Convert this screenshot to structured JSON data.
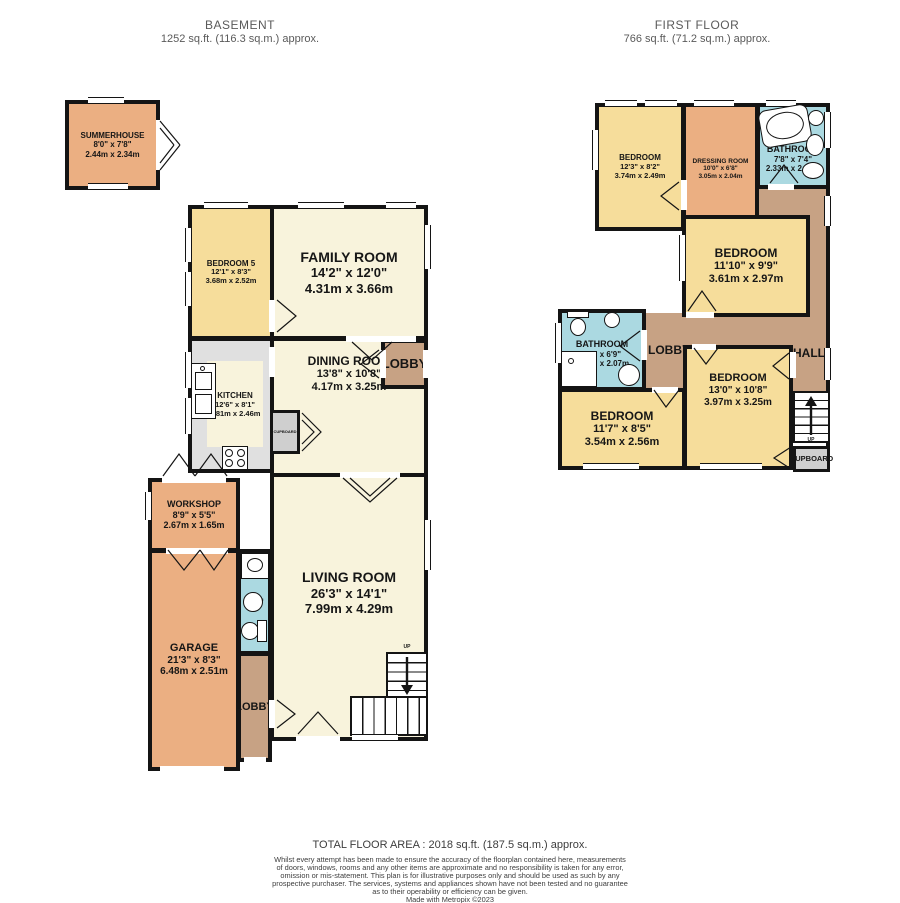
{
  "headers": {
    "basement": {
      "title": "BASEMENT",
      "area": "1252 sq.ft. (116.3 sq.m.) approx."
    },
    "first_floor": {
      "title": "FIRST FLOOR",
      "area": "766 sq.ft. (71.2 sq.m.) approx."
    }
  },
  "basement": {
    "summerhouse": {
      "name": "SUMMERHOUSE",
      "imperial": "8'0\" x 7'8\"",
      "metric": "2.44m x 2.34m"
    },
    "bedroom5": {
      "name": "BEDROOM 5",
      "imperial": "12'1\" x 8'3\"",
      "metric": "3.68m x 2.52m"
    },
    "family_room": {
      "name": "FAMILY ROOM",
      "imperial": "14'2\" x 12'0\"",
      "metric": "4.31m x 3.66m"
    },
    "kitchen": {
      "name": "KITCHEN",
      "imperial": "12'6\" x 8'1\"",
      "metric": "3.81m x 2.46m"
    },
    "dining_room": {
      "name": "DINING ROOM",
      "imperial": "13'8\" x 10'8\"",
      "metric": "4.17m x 3.25m"
    },
    "lobby_top": {
      "name": "LOBBY"
    },
    "cupboard": {
      "name": "CUPBOARD"
    },
    "living_room": {
      "name": "LIVING ROOM",
      "imperial": "26'3\" x 14'1\"",
      "metric": "7.99m x 4.29m"
    },
    "workshop": {
      "name": "WORKSHOP",
      "imperial": "8'9\" x 5'5\"",
      "metric": "2.67m x 1.65m"
    },
    "garage": {
      "name": "GARAGE",
      "imperial": "21'3\" x 8'3\"",
      "metric": "6.48m x 2.51m"
    },
    "shower_room": {
      "name": "SHOWER ROOM"
    },
    "lobby_bottom": {
      "name": "LOBBY"
    },
    "up": "UP"
  },
  "first_floor": {
    "bedroom_top": {
      "name": "BEDROOM",
      "imperial": "12'3\" x 8'2\"",
      "metric": "3.74m x 2.49m"
    },
    "dressing_room": {
      "name": "DRESSING ROOM",
      "imperial": "10'0\" x 6'8\"",
      "metric": "3.05m x 2.04m"
    },
    "bathroom_top": {
      "name": "BATHROOM",
      "imperial": "7'8\" x 7'4\"",
      "metric": "2.33m x 2.23m"
    },
    "bedroom_mid": {
      "name": "BEDROOM",
      "imperial": "11'10\" x 9'9\"",
      "metric": "3.61m x 2.97m"
    },
    "bathroom_left": {
      "name": "BATHROOM",
      "imperial": "8'3\" x 6'9\"",
      "metric": "2.52m x 2.07m"
    },
    "lobby": {
      "name": "LOBBY"
    },
    "hall": {
      "name": "HALL"
    },
    "bedroom_bl": {
      "name": "BEDROOM",
      "imperial": "11'7\" x 8'5\"",
      "metric": "3.54m x 2.56m"
    },
    "bedroom_br": {
      "name": "BEDROOM",
      "imperial": "13'0\" x 10'8\"",
      "metric": "3.97m x 3.25m"
    },
    "cupboard": {
      "name": "CUPBOARD"
    },
    "up": "UP"
  },
  "footer": {
    "total": "TOTAL FLOOR AREA : 2018 sq.ft. (187.5 sq.m.) approx.",
    "line1": "Whilst every attempt has been made to ensure the accuracy of the floorplan contained here, measurements",
    "line2": "of doors, windows, rooms and any other items are approximate and no responsibility is taken for any error,",
    "line3": "omission or mis-statement. This plan is for illustrative purposes only and should be used as such by any",
    "line4": "prospective purchaser. The services, systems and appliances shown have not been tested and no guarantee",
    "line5": "as to their operability or efficiency can be given.",
    "credit": "Made with Metropix ©2023"
  },
  "colors": {
    "bedroom_yellow": "#F6DD9B",
    "living_cream": "#F8F3DC",
    "garage_orange": "#EBAF82",
    "hall_tan": "#C7A284",
    "bath_blue": "#ABD9E1",
    "kitchen_gray": "#E0E0E0",
    "cupboard_gray": "#CFCFCF",
    "wall_black": "#141414"
  }
}
